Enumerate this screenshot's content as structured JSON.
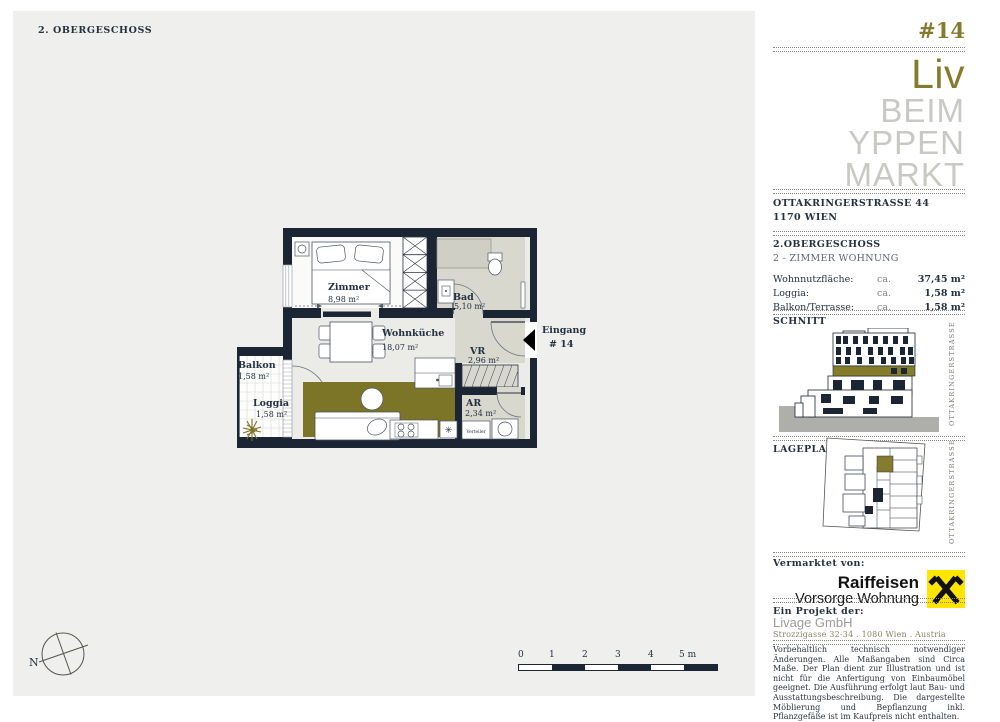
{
  "colors": {
    "accent_olive": "#857B2D",
    "wall_navy": "#1B2533",
    "raiffeisen_yellow": "#FFE500",
    "floor_beige": "#D8D8CE"
  },
  "page": {
    "floor_label": "2. OBERGESCHOSS",
    "compass_north": "N"
  },
  "floorplan": {
    "rooms": [
      {
        "name": "Zimmer",
        "area": "8,98 m²"
      },
      {
        "name": "Wohnküche",
        "area": "18,07 m²"
      },
      {
        "name": "Bad",
        "area": "5,10 m²"
      },
      {
        "name": "VR",
        "area": "2,96 m²"
      },
      {
        "name": "AR",
        "area": "2,34 m²"
      },
      {
        "name": "Balkon",
        "area": "1,58 m²"
      },
      {
        "name": "Loggia",
        "area": "1,58 m²"
      }
    ],
    "entrance": {
      "label": "Eingang",
      "number": "# 14"
    },
    "verteiler_label": "Verteiler",
    "vent_symbol": "✳",
    "scale_ticks": [
      "0",
      "1",
      "2",
      "3",
      "4",
      "5 m"
    ]
  },
  "sidebar": {
    "unit_number": "#14",
    "logo": {
      "line1": "Liv",
      "line2": "BEIM",
      "line3": "YPPEN",
      "line4": "MARKT"
    },
    "address": {
      "line1": "OTTAKRINGERSTRASSE 44",
      "line2": "1170 WIEN"
    },
    "unit": {
      "floor": "2.OBERGESCHOSS",
      "type": "2 - ZIMMER WOHNUNG",
      "rows": [
        {
          "label": "Wohnnutzfläche:",
          "ca": "ca.",
          "value": "37,45 m²"
        },
        {
          "label": "Loggia:",
          "ca": "ca.",
          "value": "1,58 m²"
        },
        {
          "label": "Balkon/Terrasse:",
          "ca": "ca.",
          "value": "1,58 m²"
        }
      ]
    },
    "schnitt": {
      "title": "SCHNITT",
      "street": "OTTAKRINGERSTRASSE"
    },
    "lageplan": {
      "title": "LAGEPLAN",
      "street": "OTTAKRINGERSTRASSE"
    },
    "marketing": {
      "label": "Vermarktet von:",
      "brand1": "Raiffeisen",
      "brand2": "Vorsorge Wohnung"
    },
    "project": {
      "label": "Ein Projekt der:",
      "company": "Livage GmbH",
      "address": "Strozzigasse 32-34 . 1080 Wien . Austria"
    },
    "disclaimer": "Vorbehaltlich technisch notwendiger Änderungen. Alle Maßangaben sind Circa Maße. Der Plan dient zur Illustration und ist nicht für die Anfertigung von Einbaumöbel geeignet. Die Ausführung erfolgt laut Bau- und Ausstattungsbeschreibung. Die dargestellte Möblierung und Bepflanzung inkl. Pflanzgefäße ist im Kaufpreis nicht enthalten."
  }
}
